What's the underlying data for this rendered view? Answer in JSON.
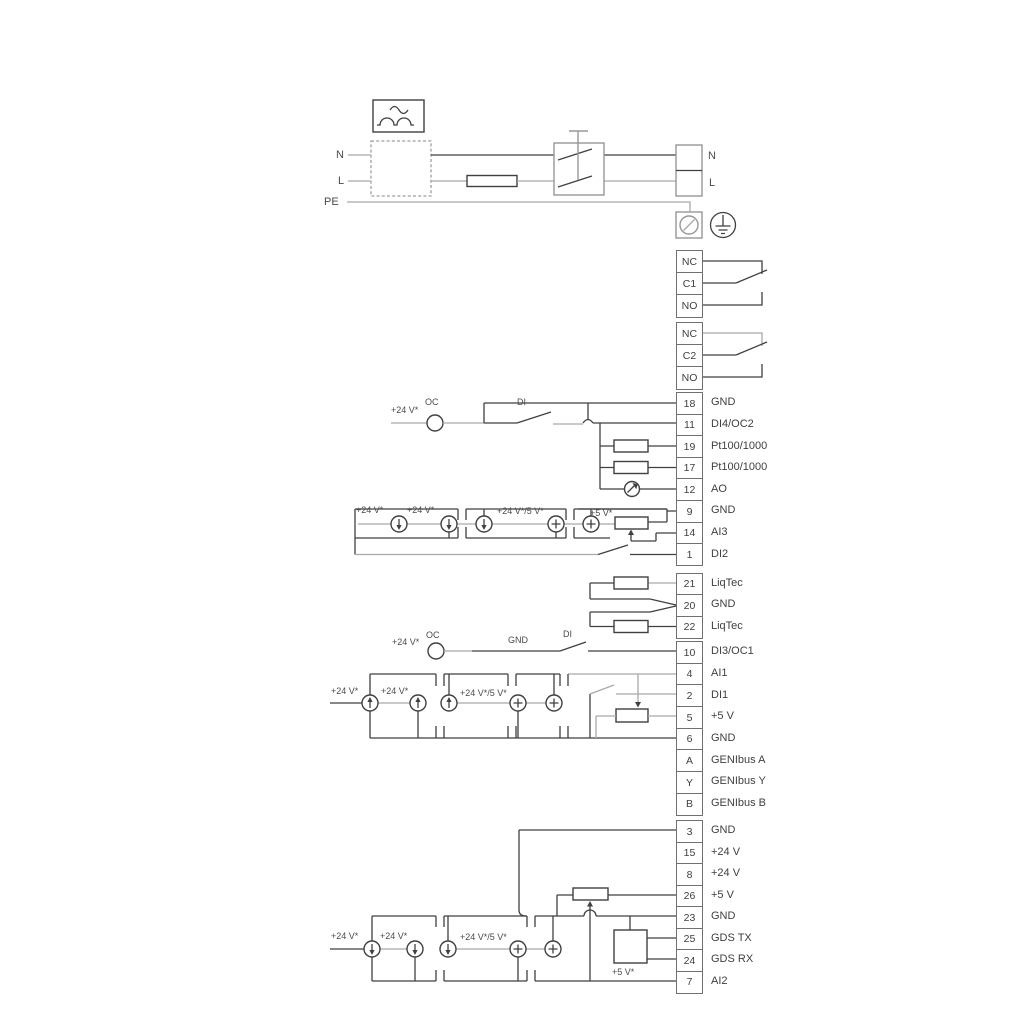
{
  "diagram_type": "electrical-wiring-diagram",
  "colors": {
    "line_dark": "#3f4042",
    "line_gray": "#a7a9ac",
    "text": "#3e3f41"
  },
  "power": {
    "n_left": "N",
    "l_left": "L",
    "pe": "PE",
    "n_right": "N",
    "l_right": "L"
  },
  "relay_blocks": [
    {
      "top": 250,
      "pitch": 22,
      "cells": [
        "NC",
        "C1",
        "NO"
      ]
    },
    {
      "top": 322,
      "pitch": 22,
      "cells": [
        "NC",
        "C2",
        "NO"
      ]
    }
  ],
  "terminal_groups": [
    {
      "top": 392,
      "pitch": 21.6,
      "rows": [
        [
          "18",
          "GND"
        ],
        [
          "11",
          "DI4/OC2"
        ],
        [
          "19",
          "Pt100/1000"
        ],
        [
          "17",
          "Pt100/1000"
        ],
        [
          "12",
          "AO"
        ],
        [
          "9",
          "GND"
        ],
        [
          "14",
          "AI3"
        ],
        [
          "1",
          "DI2"
        ]
      ]
    },
    {
      "top": 572.5,
      "pitch": 21.5,
      "rows": [
        [
          "21",
          "LiqTec"
        ],
        [
          "20",
          "GND"
        ],
        [
          "22",
          "LiqTec"
        ]
      ]
    },
    {
      "top": 641,
      "pitch": 21.65,
      "rows": [
        [
          "10",
          "DI3/OC1"
        ],
        [
          "4",
          "AI1"
        ],
        [
          "2",
          "DI1"
        ],
        [
          "5",
          "+5 V"
        ],
        [
          "6",
          "GND"
        ],
        [
          "A",
          "GENIbus A"
        ],
        [
          "Y",
          "GENIbus Y"
        ],
        [
          "B",
          "GENIbus B"
        ]
      ]
    },
    {
      "top": 820,
      "pitch": 21.5,
      "rows": [
        [
          "3",
          "GND"
        ],
        [
          "15",
          "+24 V"
        ],
        [
          "8",
          "+24 V"
        ],
        [
          "26",
          "+5 V"
        ],
        [
          "23",
          "GND"
        ],
        [
          "25",
          "GDS TX"
        ],
        [
          "24",
          "GDS RX"
        ],
        [
          "7",
          "AI2"
        ]
      ]
    }
  ],
  "wire_labels": [
    {
      "t": "OC",
      "x": 425,
      "y": 397
    },
    {
      "t": "+24 V*",
      "x": 391,
      "y": 405
    },
    {
      "t": "DI",
      "x": 517,
      "y": 397
    },
    {
      "t": "+24 V*",
      "x": 356,
      "y": 505
    },
    {
      "t": "+24 V*",
      "x": 407,
      "y": 505
    },
    {
      "t": "+24 V*/5 V*",
      "x": 497,
      "y": 506
    },
    {
      "t": "+5 V*",
      "x": 590,
      "y": 508
    },
    {
      "t": "OC",
      "x": 426,
      "y": 630
    },
    {
      "t": "+24 V*",
      "x": 392,
      "y": 637
    },
    {
      "t": "GND",
      "x": 508,
      "y": 635
    },
    {
      "t": "DI",
      "x": 563,
      "y": 629
    },
    {
      "t": "+24 V*",
      "x": 331,
      "y": 686
    },
    {
      "t": "+24 V*",
      "x": 381,
      "y": 686
    },
    {
      "t": "+24 V*/5 V*",
      "x": 460,
      "y": 688
    },
    {
      "t": "+24 V*",
      "x": 331,
      "y": 931
    },
    {
      "t": "+24 V*",
      "x": 380,
      "y": 931
    },
    {
      "t": "+24 V*/5 V*",
      "x": 460,
      "y": 932
    },
    {
      "t": "+5 V*",
      "x": 612,
      "y": 967
    }
  ]
}
